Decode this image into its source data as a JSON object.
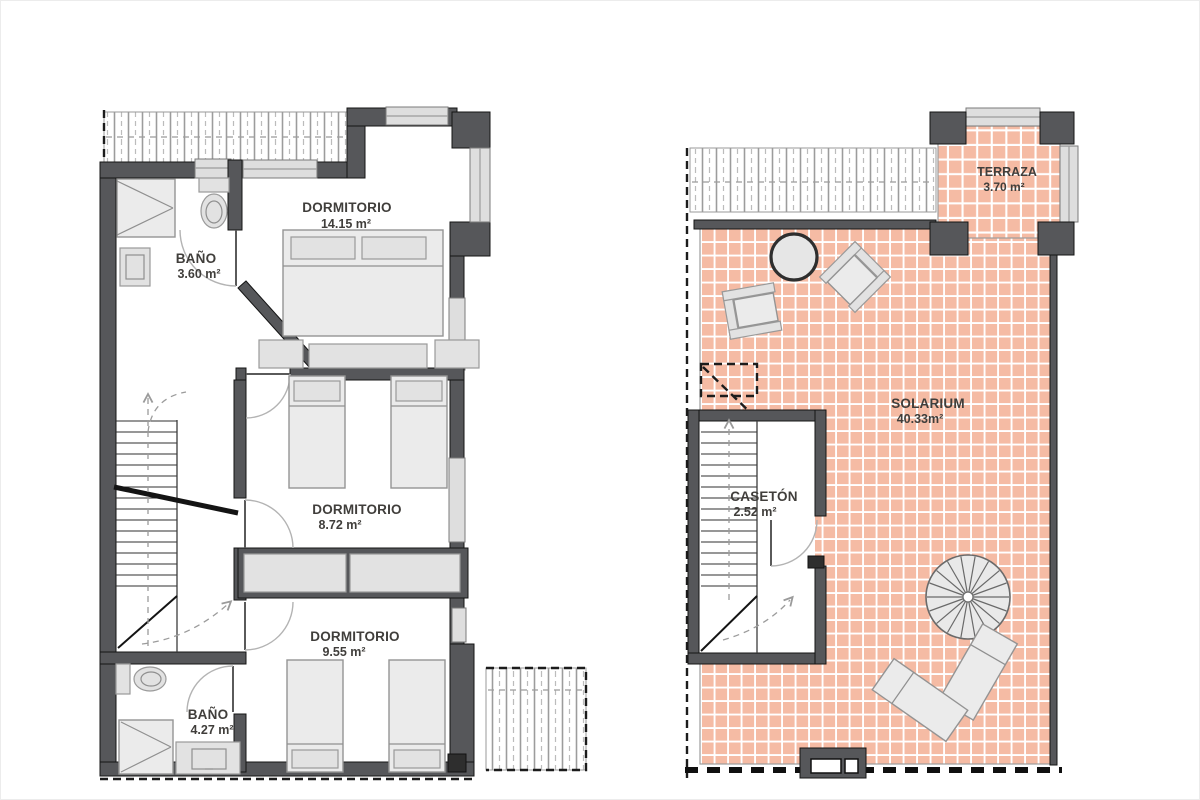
{
  "document": {
    "kind": "architectural floor plan, two plans side by side",
    "plans": {
      "upper_floor": {
        "rooms": [
          {
            "name": "BAÑO",
            "area": "3.60 m²"
          },
          {
            "name": "DORMITORIO",
            "area": "14.15 m²"
          },
          {
            "name": "DORMITORIO",
            "area": "8.72 m²"
          },
          {
            "name": "DORMITORIO",
            "area": "9.55 m²"
          },
          {
            "name": "BAÑO",
            "area": "4.27 m²"
          }
        ]
      },
      "roof_floor": {
        "rooms": [
          {
            "name": "TERRAZA",
            "area": "3.70 m²"
          },
          {
            "name": "SOLARIUM",
            "area": "40.33m²"
          },
          {
            "name": "CASETÓN",
            "area": "2.52 m²"
          }
        ]
      }
    },
    "colors": {
      "wall": "#56575a",
      "tile": "#f5bba4",
      "grout": "#ffffff",
      "furniture_fill": "#ebebeb",
      "label_text": "#403e3b",
      "background": "#ffffff"
    },
    "symbols": {
      "double-bed": "rectangle with pillows",
      "single-bed": "rectangle with pillow",
      "wardrobe": "recessed rectangle pair",
      "shower": "square with corner diagonals",
      "toilet": "tank and bowl",
      "washbasin": "rectangle with inner basin",
      "staircase": "parallel treads with direction line",
      "spiral-staircase": "circle with radial spokes",
      "round-table": "bold circle",
      "armchair": "square with arm strips",
      "sun-lounger": "tilted rectangle",
      "roof": "hatched strip",
      "door": "quarter-circle swing",
      "window": "light gray bar",
      "vent": "dark box with openings"
    }
  }
}
